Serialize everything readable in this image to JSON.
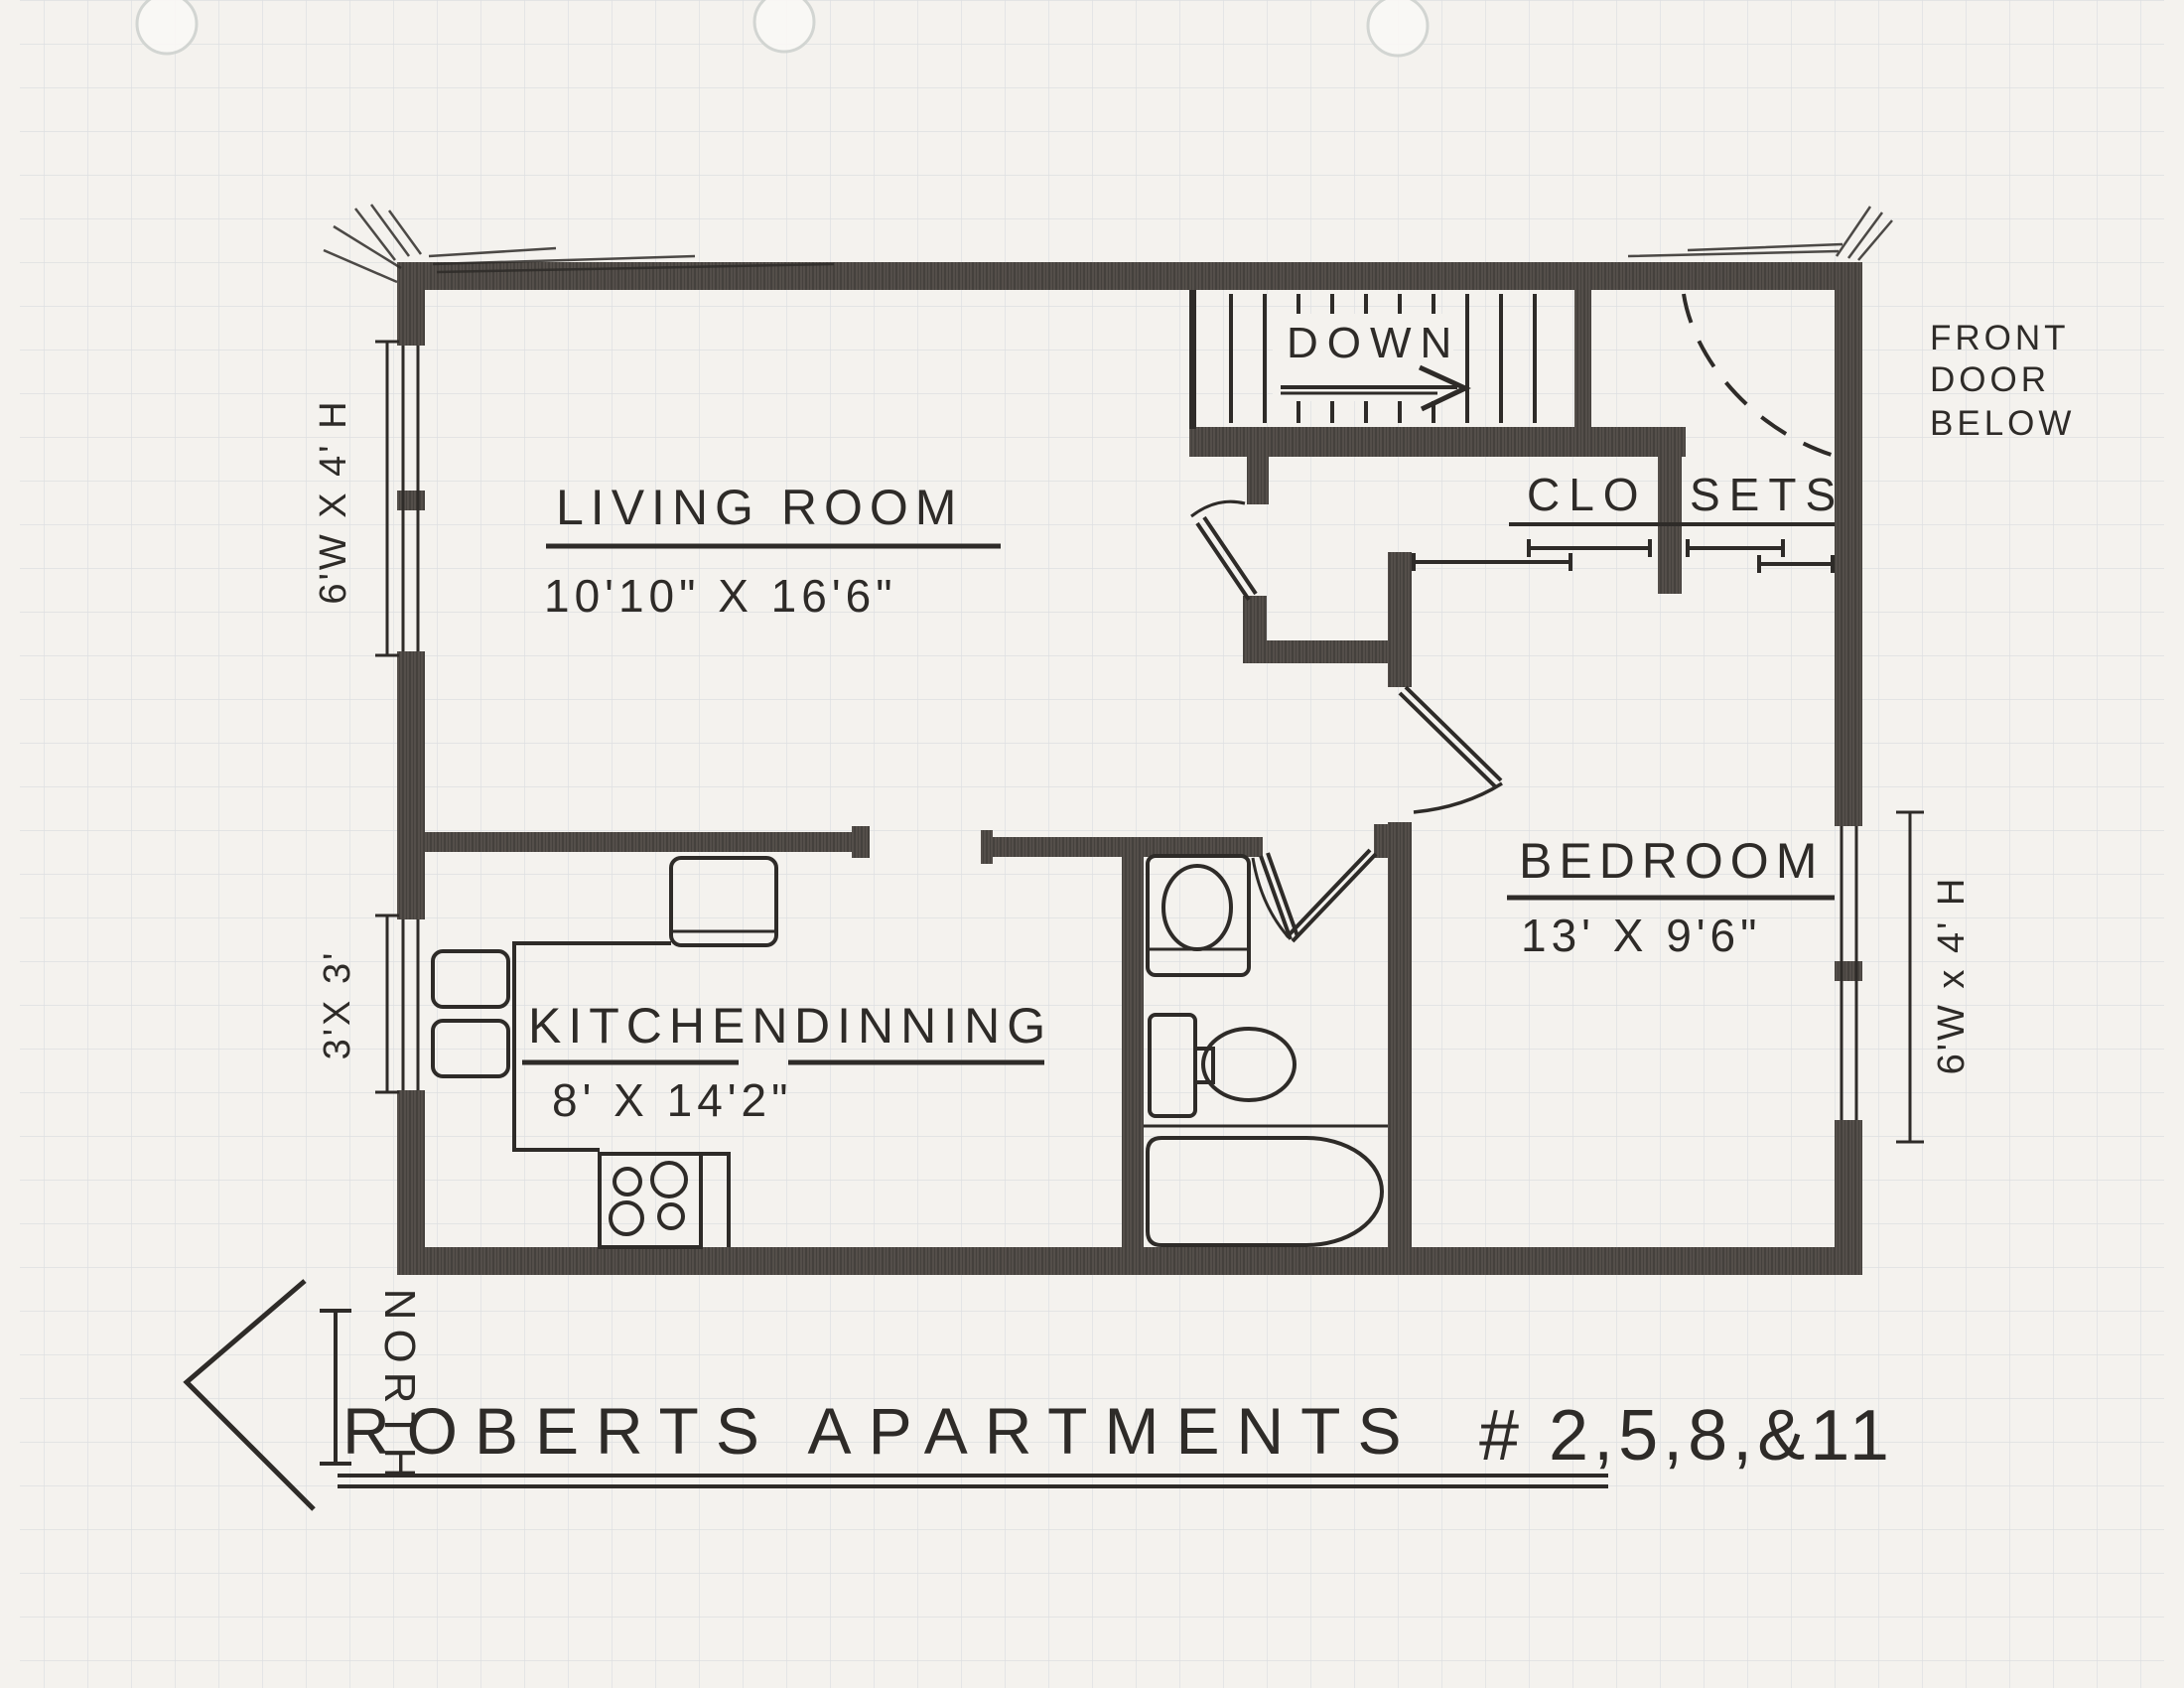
{
  "title": {
    "main": "ROBERTS APARTMENTS",
    "units": "# 2,5,8,&11"
  },
  "compass": {
    "north": "NORTH"
  },
  "stairs": {
    "down": "DOWN"
  },
  "front_door_note": {
    "line1": "FRONT",
    "line2": "DOOR",
    "line3": "BELOW"
  },
  "rooms": {
    "living_room": {
      "name": "LIVING ROOM",
      "dims": "10'10\" X 16'6\""
    },
    "kitchen": {
      "name": "KITCHEN",
      "dims": "8' X 14'2\""
    },
    "dining": {
      "name": "DINNING"
    },
    "bedroom": {
      "name": "BEDROOM",
      "dims": "13' X 9'6\""
    },
    "closets": {
      "left": "CLO",
      "right": "SETS"
    }
  },
  "windows": {
    "left_large": "6'W X 4' H",
    "left_small": "3'X 3'",
    "right_large": "6'W x 4' H"
  },
  "colors": {
    "paper": "#f4f2ee",
    "ink": "#2e2b28",
    "wall": "#45413d",
    "grid": "#c9cfd7"
  }
}
